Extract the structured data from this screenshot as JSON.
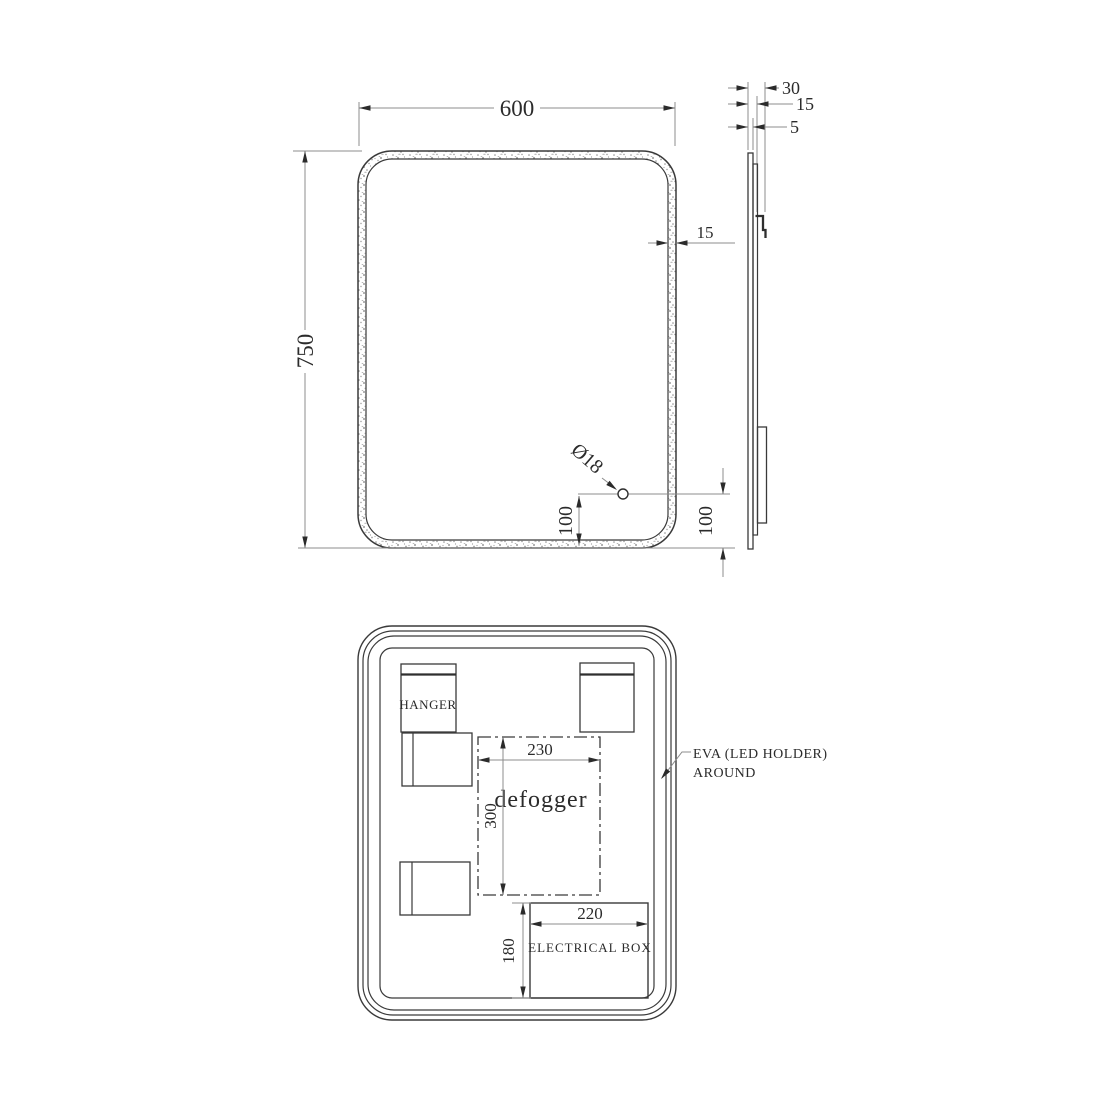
{
  "drawing": {
    "front_view": {
      "width": "600",
      "height": "750",
      "border": "15",
      "hole_dia": "Ø18",
      "hole_offset": "100"
    },
    "side_view": {
      "total_depth": "30",
      "mid_depth": "15",
      "glass_thickness": "5",
      "bottom_offset": "100"
    },
    "back_view": {
      "hanger_label": "HANGER",
      "defogger_label": "defogger",
      "defogger_width": "230",
      "defogger_height": "300",
      "electrical_box_label": "ELECTRICAL BOX",
      "electrical_box_width": "220",
      "electrical_box_height": "180",
      "eva_note_line1": "EVA (LED HOLDER)",
      "eva_note_line2": "AROUND"
    },
    "colors": {
      "object_line": "#3a3a3a",
      "dimension_line": "#8c8c8c",
      "text": "#2b2b2b",
      "background": "#ffffff"
    }
  }
}
